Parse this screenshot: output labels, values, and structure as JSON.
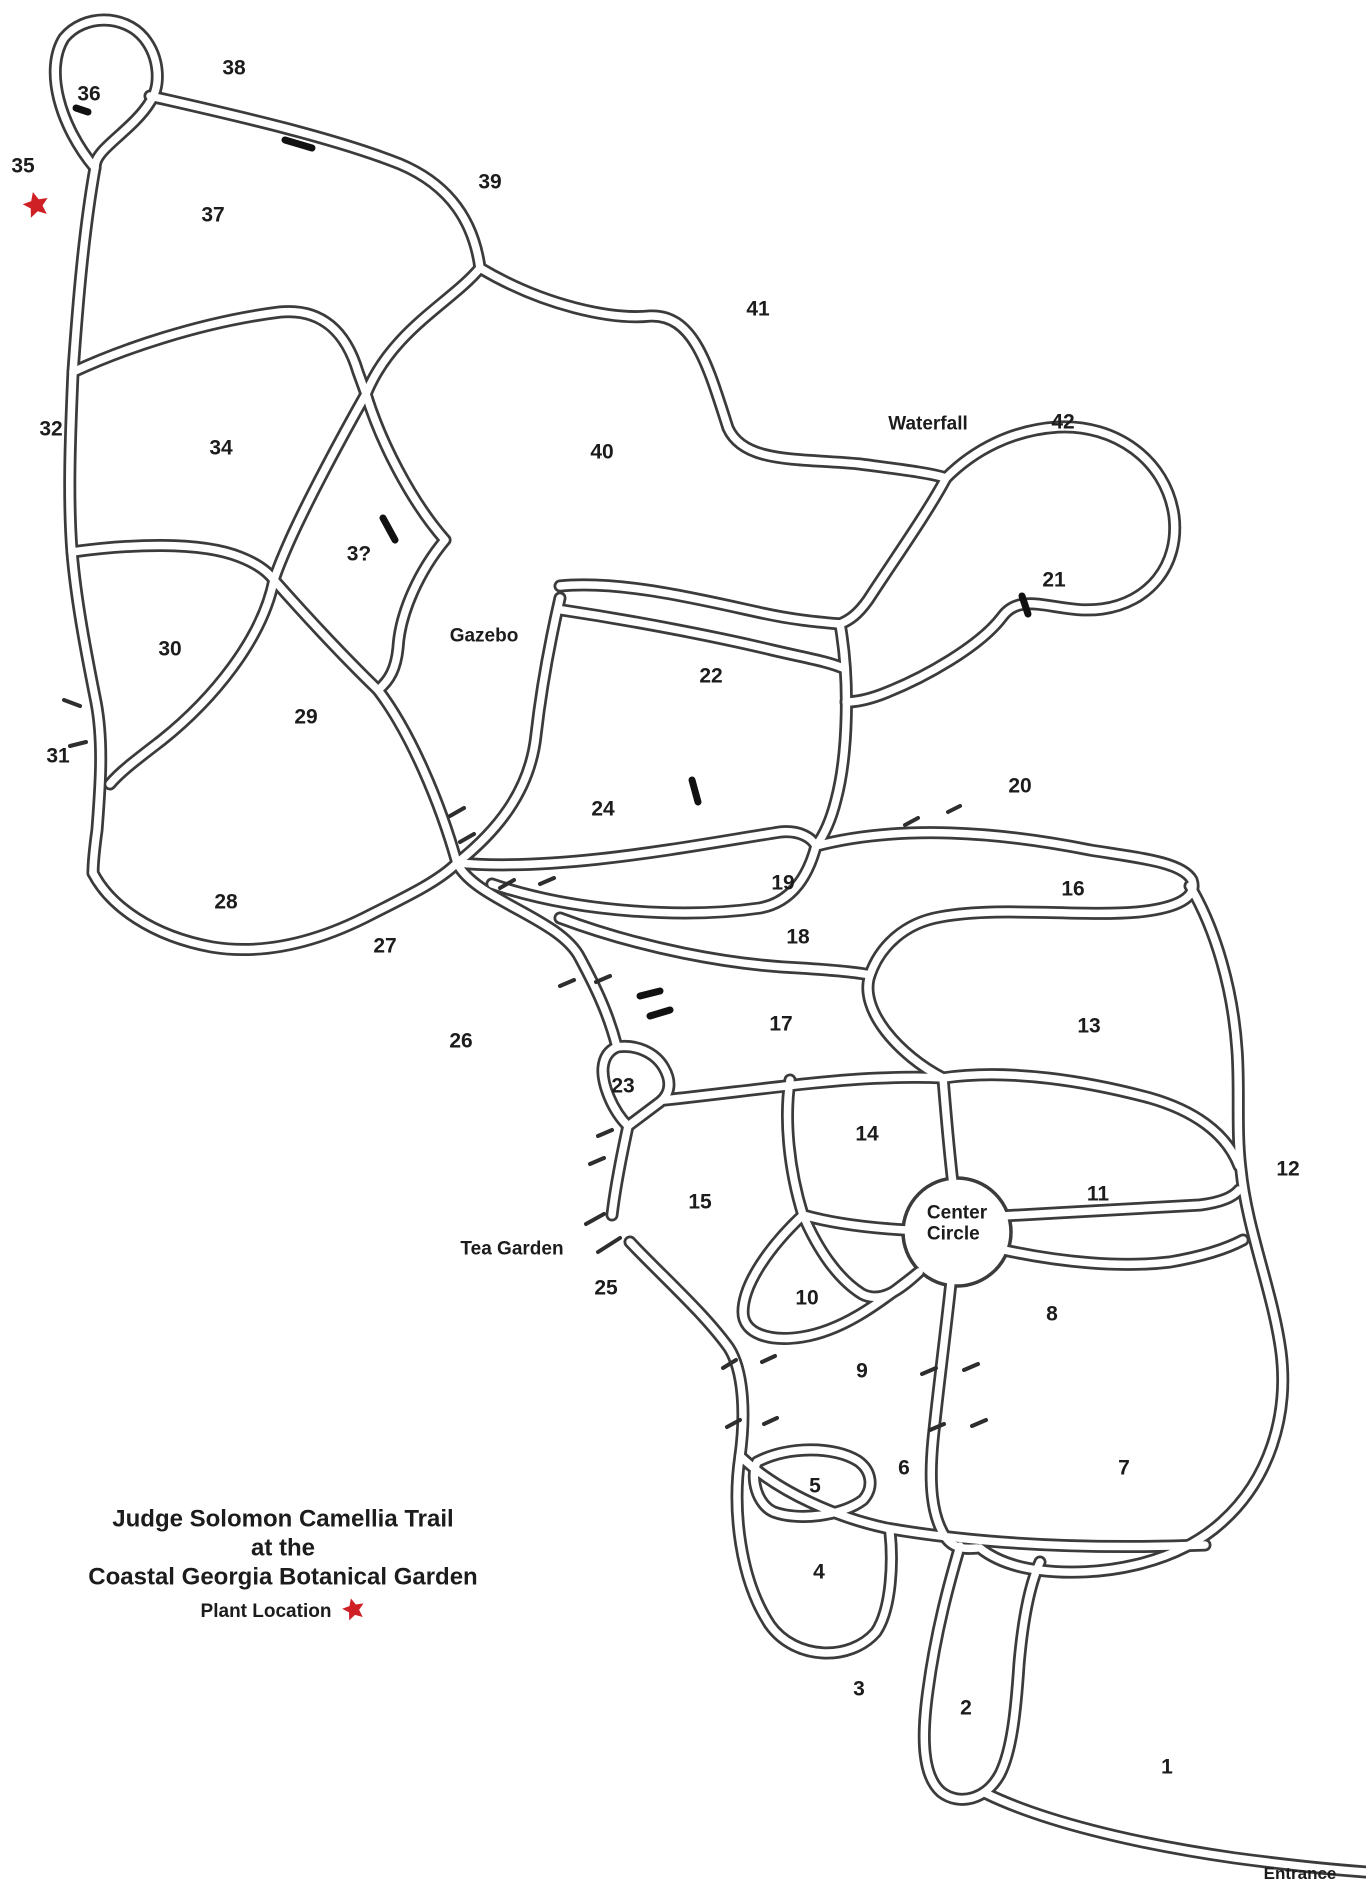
{
  "map": {
    "width": 1366,
    "height": 1890,
    "background_color": "#ffffff",
    "trail_line_color": "#3b3b3b",
    "star_color": "#cf2026"
  },
  "title": {
    "line1": "Judge Solomon Camellia Trail",
    "line2": "at the",
    "line3": "Coastal Georgia Botanical Garden",
    "legend_label": "Plant Location"
  },
  "landmarks": {
    "waterfall": {
      "label": "Waterfall",
      "x": 928,
      "y": 425
    },
    "gazebo": {
      "label": "Gazebo",
      "x": 484,
      "y": 637
    },
    "tea_garden": {
      "label": "Tea Garden",
      "x": 512,
      "y": 1250
    },
    "center_circle": {
      "label_line1": "Center",
      "label_line2": "Circle",
      "x": 921,
      "y": 1224
    },
    "entrance": {
      "label": "Entrance",
      "x": 1300,
      "y": 1874
    }
  },
  "stars": [
    {
      "name": "plant-location-star-nw",
      "x": 36,
      "y": 207,
      "size": 28
    },
    {
      "name": "plant-location-star-legend",
      "x": 343,
      "y": 1612,
      "size": 24
    }
  ],
  "sections": [
    {
      "n": 1,
      "label": "1",
      "x": 1167,
      "y": 1768
    },
    {
      "n": 2,
      "label": "2",
      "x": 966,
      "y": 1709
    },
    {
      "n": 3,
      "label": "3",
      "x": 859,
      "y": 1690
    },
    {
      "n": 4,
      "label": "4",
      "x": 819,
      "y": 1573
    },
    {
      "n": 5,
      "label": "5",
      "x": 815,
      "y": 1487
    },
    {
      "n": 6,
      "label": "6",
      "x": 904,
      "y": 1469
    },
    {
      "n": 7,
      "label": "7",
      "x": 1124,
      "y": 1469
    },
    {
      "n": 8,
      "label": "8",
      "x": 1052,
      "y": 1315
    },
    {
      "n": 9,
      "label": "9",
      "x": 862,
      "y": 1372
    },
    {
      "n": 10,
      "label": "10",
      "x": 807,
      "y": 1299
    },
    {
      "n": 11,
      "label": "11",
      "x": 1098,
      "y": 1195
    },
    {
      "n": 12,
      "label": "12",
      "x": 1288,
      "y": 1170
    },
    {
      "n": 13,
      "label": "13",
      "x": 1089,
      "y": 1027
    },
    {
      "n": 14,
      "label": "14",
      "x": 867,
      "y": 1135
    },
    {
      "n": 15,
      "label": "15",
      "x": 700,
      "y": 1203
    },
    {
      "n": 16,
      "label": "16",
      "x": 1073,
      "y": 890
    },
    {
      "n": 17,
      "label": "17",
      "x": 781,
      "y": 1025
    },
    {
      "n": 18,
      "label": "18",
      "x": 798,
      "y": 938
    },
    {
      "n": 19,
      "label": "19",
      "x": 783,
      "y": 884
    },
    {
      "n": 20,
      "label": "20",
      "x": 1020,
      "y": 787
    },
    {
      "n": 21,
      "label": "21",
      "x": 1054,
      "y": 581
    },
    {
      "n": 22,
      "label": "22",
      "x": 711,
      "y": 677
    },
    {
      "n": 23,
      "label": "23",
      "x": 623,
      "y": 1087
    },
    {
      "n": 24,
      "label": "24",
      "x": 603,
      "y": 810
    },
    {
      "n": 25,
      "label": "25",
      "x": 606,
      "y": 1289
    },
    {
      "n": 26,
      "label": "26",
      "x": 461,
      "y": 1042
    },
    {
      "n": 27,
      "label": "27",
      "x": 385,
      "y": 947
    },
    {
      "n": 28,
      "label": "28",
      "x": 226,
      "y": 903
    },
    {
      "n": 29,
      "label": "29",
      "x": 306,
      "y": 718
    },
    {
      "n": 30,
      "label": "30",
      "x": 170,
      "y": 650
    },
    {
      "n": 31,
      "label": "31",
      "x": 58,
      "y": 757
    },
    {
      "n": 32,
      "label": "32",
      "x": 51,
      "y": 430
    },
    {
      "n": 33,
      "label": "3?",
      "x": 359,
      "y": 555
    },
    {
      "n": 34,
      "label": "34",
      "x": 221,
      "y": 449
    },
    {
      "n": 35,
      "label": "35",
      "x": 23,
      "y": 167
    },
    {
      "n": 36,
      "label": "36",
      "x": 89,
      "y": 95
    },
    {
      "n": 37,
      "label": "37",
      "x": 213,
      "y": 216
    },
    {
      "n": 38,
      "label": "38",
      "x": 234,
      "y": 69
    },
    {
      "n": 39,
      "label": "39",
      "x": 490,
      "y": 183
    },
    {
      "n": 40,
      "label": "40",
      "x": 602,
      "y": 453
    },
    {
      "n": 41,
      "label": "41",
      "x": 758,
      "y": 310
    },
    {
      "n": 42,
      "label": "42",
      "x": 1063,
      "y": 423
    }
  ]
}
